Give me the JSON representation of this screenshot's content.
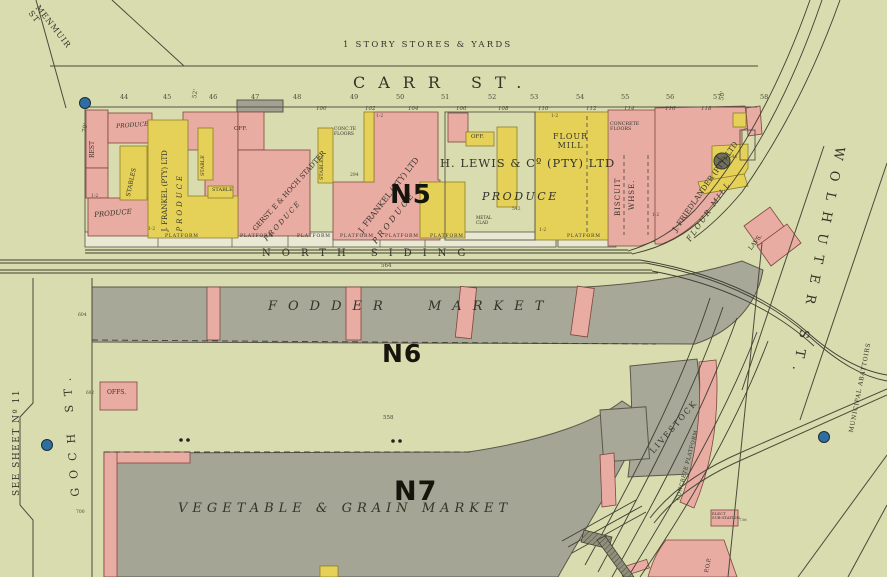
{
  "colors": {
    "paper": "#d9dcae",
    "building_pink": "#e9aca3",
    "building_yellow": "#e6d158",
    "building_gray": "#a7a897",
    "platform_white": "#e9e8d2",
    "hydrant_blue": "#2f6f9f",
    "line": "#4a4a3c"
  },
  "sheet": {
    "see_sheet_note": "SEE SHEET Nº 11"
  },
  "streets": {
    "menmuir": "MENMUIR\nST",
    "carr": "CARR ST.",
    "goch": "GOCH ST.",
    "wolhuter": "WOLHUTER ST.",
    "north_siding": "NORTH SIDING",
    "municipal_abattoirs": "MUNICIPAL ABATTOIRS"
  },
  "areas": {
    "stores_yards": "1 STORY STORES & YARDS",
    "n5": "N5",
    "fodder_block": "N6",
    "fodder_name1": "FODDER",
    "fodder_name2": "MARKET",
    "veg_block": "N7",
    "veg_name": "VEGETABLE & GRAIN MARKET"
  },
  "buildings": {
    "rest": "REST",
    "produce": "PRODUCE",
    "stables": "STABLES",
    "stable": "STABLE",
    "off": "OFF.",
    "offs": "OFFS.",
    "frankel_line1": "J. FRANKEL (PTY) LTD",
    "gerst_line1": "GERST. E & HOCH STADTER",
    "h_lewis": "H. LEWIS & Cº (PTY) LTD",
    "flour_mill_2line": "FLOUR\nMILL",
    "flour_mill": "FLOUR MILL",
    "concrete_floors": "CONCRETE\nFLOORS",
    "conc_floors_small": "CONC.TE\nFLOORS",
    "biscuit": "BISCUIT",
    "whse": "WHSE.",
    "friedlander_line1": "J. FRIEDLANDER (PTY) LTD",
    "metal_clad": "METAL\nCLAD",
    "livestock": "LIVESTOCK",
    "concrete_platform": "CONCRETE PLATFORM",
    "lavs": "LAVS.",
    "elect_substation": "ELECT\nSUB-STATION",
    "pop": "P.O.P.",
    "platform": "PLATFORM"
  },
  "numbers": {
    "top": [
      "44",
      "45",
      "46",
      "47",
      "48",
      "49",
      "50",
      "51",
      "52",
      "53",
      "54",
      "55",
      "56",
      "57",
      "58"
    ],
    "frontage": [
      "100",
      "102",
      "104",
      "106",
      "108",
      "110",
      "112",
      "114",
      "116",
      "118"
    ],
    "siding": "564",
    "market_558": "558",
    "fodder_604": "604",
    "offs_602": "602",
    "veg_700": "700",
    "lewis_542": "542",
    "frankel_294": "294",
    "friedlander_544": "544",
    "elect_736": "736"
  },
  "dims": {
    "d70": "70'",
    "d52": "52'",
    "d50": "50'",
    "storeys": "1-2"
  }
}
